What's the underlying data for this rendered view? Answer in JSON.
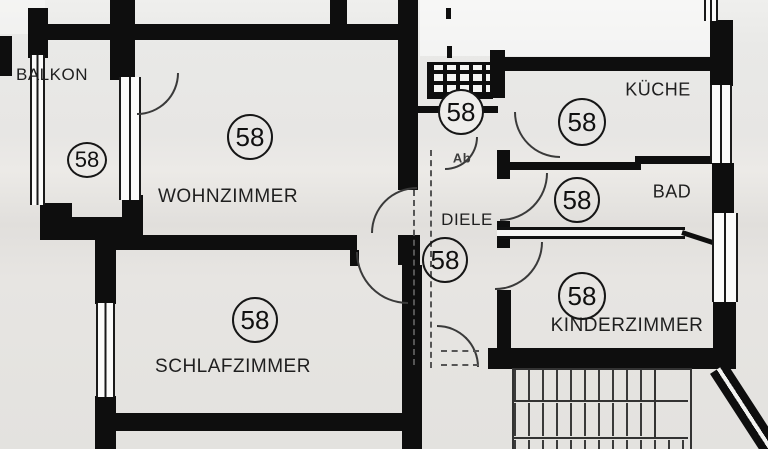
{
  "plan": {
    "unit_number": "58",
    "rooms": [
      {
        "key": "balkon",
        "label": "BALKON",
        "number": "58"
      },
      {
        "key": "wohnzimmer",
        "label": "WOHNZIMMER",
        "number": "58"
      },
      {
        "key": "schlafzimmer",
        "label": "SCHLAFZIMMER",
        "number": "58"
      },
      {
        "key": "diele",
        "label": "DIELE",
        "number": "58"
      },
      {
        "key": "abstell",
        "label": "Ab",
        "number": "58"
      },
      {
        "key": "kueche",
        "label": "KÜCHE",
        "number": "58"
      },
      {
        "key": "bad",
        "label": "BAD",
        "number": "58"
      },
      {
        "key": "kinderzimmer",
        "label": "KINDERZIMMER",
        "number": "58"
      }
    ],
    "colors": {
      "wall": "#0e0e0e",
      "background": "#e8e7e4",
      "drawing_line": "#333333"
    }
  }
}
